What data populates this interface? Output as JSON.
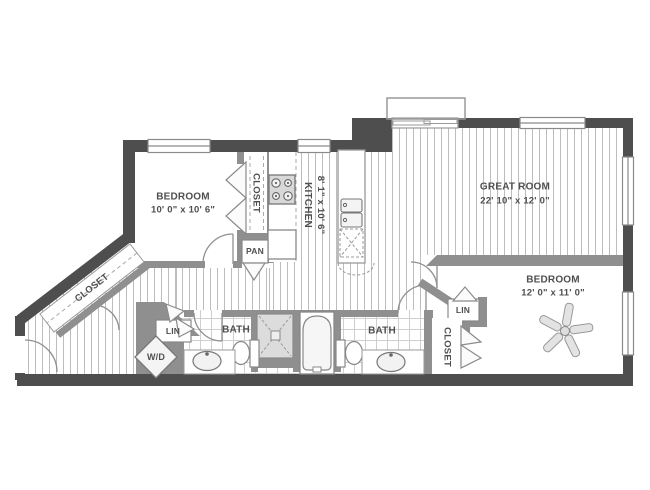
{
  "page": {
    "width": 650,
    "height": 490,
    "background": "#ffffff"
  },
  "colors": {
    "wall_exterior": "#4e4e4e",
    "wall_interior": "#8f8f8f",
    "floor_hatch_line": "#bdbdbd",
    "tile_line": "#cfcfcf",
    "fixture_fill": "#e0e0e0",
    "label_text": "#4f4f4f"
  },
  "rooms": {
    "bedroom1": {
      "name": "BEDROOM",
      "dims": "10' 0\" x 10' 6\""
    },
    "kitchen": {
      "name": "KITCHEN",
      "dims": "8' 1\" x 10' 6\""
    },
    "great_room": {
      "name": "GREAT ROOM",
      "dims": "22' 10\" x 12' 0\""
    },
    "bedroom2": {
      "name": "BEDROOM",
      "dims": "12' 0\" x 11' 0\""
    }
  },
  "labels": {
    "closet": "CLOSET",
    "pantry": "PAN",
    "linen": "LIN",
    "bath": "BATH",
    "washer_dryer": "W/D"
  },
  "fixtures": [
    "stove-icon",
    "refrigerator-icon",
    "island-double-sink-icon",
    "dishwasher-icon",
    "shower-icon",
    "bathtub-icon",
    "toilet-icon",
    "vanity-sink-icon",
    "washer-dryer-icon",
    "ceiling-fan-icon",
    "door-swing-arc",
    "bifold-door",
    "window"
  ]
}
